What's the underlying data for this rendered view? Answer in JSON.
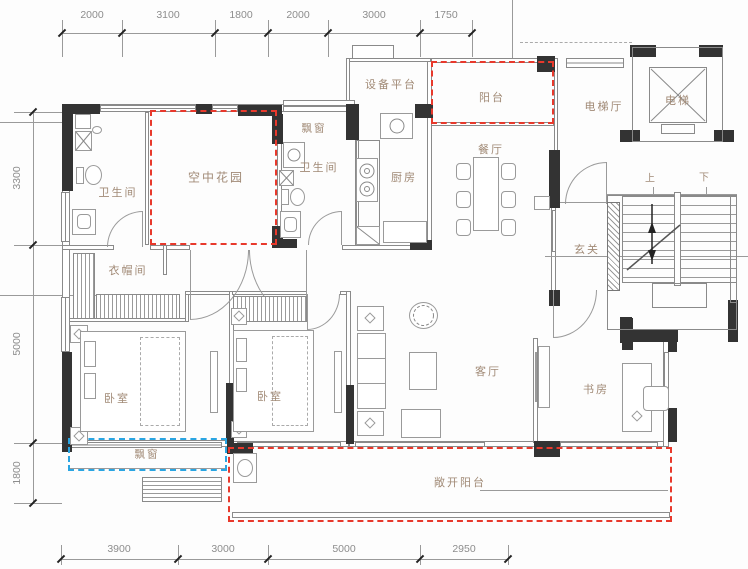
{
  "colors": {
    "wall_black": "#333333",
    "thin_line": "#8a8a8a",
    "room_label": "#a18a76",
    "dimension_text": "#8d8d8d",
    "red_dashed": "#e8392c",
    "blue_dashed": "#2aa5e2",
    "background": "#fdfdfd"
  },
  "dims": {
    "top": [
      "2000",
      "3100",
      "1800",
      "2000",
      "3000",
      "1750"
    ],
    "left": [
      "3300",
      "5000",
      "1800"
    ],
    "bottom": [
      "3900",
      "3000",
      "5000",
      "2950"
    ]
  },
  "rooms": {
    "bath1": "卫生间",
    "sky_garden": "空中花园",
    "bay_top": "飘窗",
    "bath2": "卫生间",
    "equipment": "设备平台",
    "kitchen": "厨房",
    "balcony": "阳台",
    "dining": "餐厅",
    "elevator_hall": "电梯厅",
    "elevator": "电梯",
    "foyer": "玄关",
    "cloakroom": "衣帽间",
    "bedroom1": "卧室",
    "bedroom2": "卧室",
    "living": "客厅",
    "study": "书房",
    "bay_bottom": "飘窗",
    "open_balcony": "敞开阳台"
  },
  "stairs": {
    "up": "上",
    "down": "下"
  }
}
